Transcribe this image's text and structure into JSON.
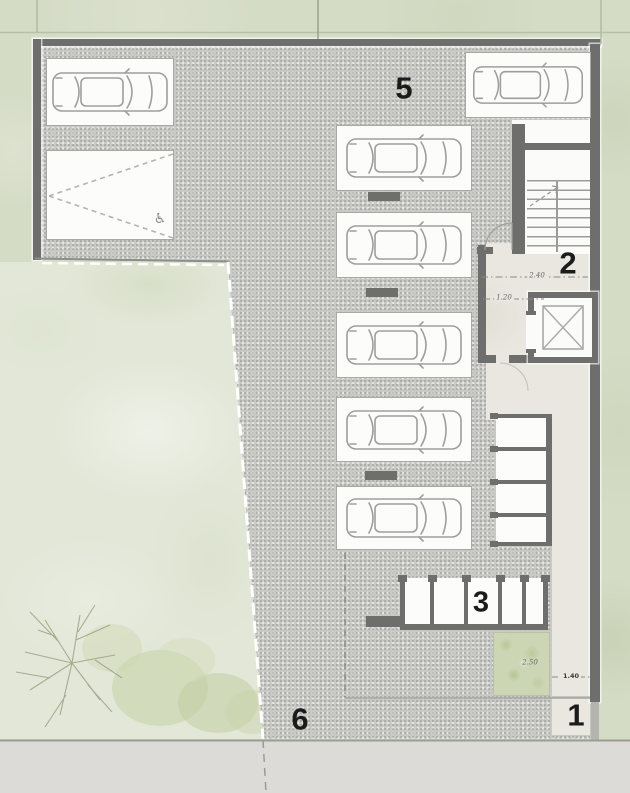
{
  "plan": {
    "type": "architectural-floor-plan",
    "level": "garage-parking-level"
  },
  "zones": {
    "parking_area": {
      "label": "5"
    },
    "stair_core": {
      "label": "2"
    },
    "storage_row": {
      "label": "3"
    },
    "driveway": {
      "label": "6"
    },
    "entry_walkway": {
      "label": "1"
    }
  },
  "dimensions": {
    "stair_lobby_width": "2.40",
    "elevator_lobby_width": "1.20",
    "planter_width": "2.50",
    "walkway_width": "1.40"
  },
  "icons": {
    "accessible_parking": "♿"
  },
  "palette": {
    "site_green": "#d5dcc6",
    "garden_green": "#e3e7d8",
    "floor_gray": "#c8c8c5",
    "marble_floor": "#e9e7e0",
    "wall_gray": "#6e6e6c",
    "planter_green": "#ccd6b5",
    "sidewalk_gray": "#dcdbd7"
  }
}
